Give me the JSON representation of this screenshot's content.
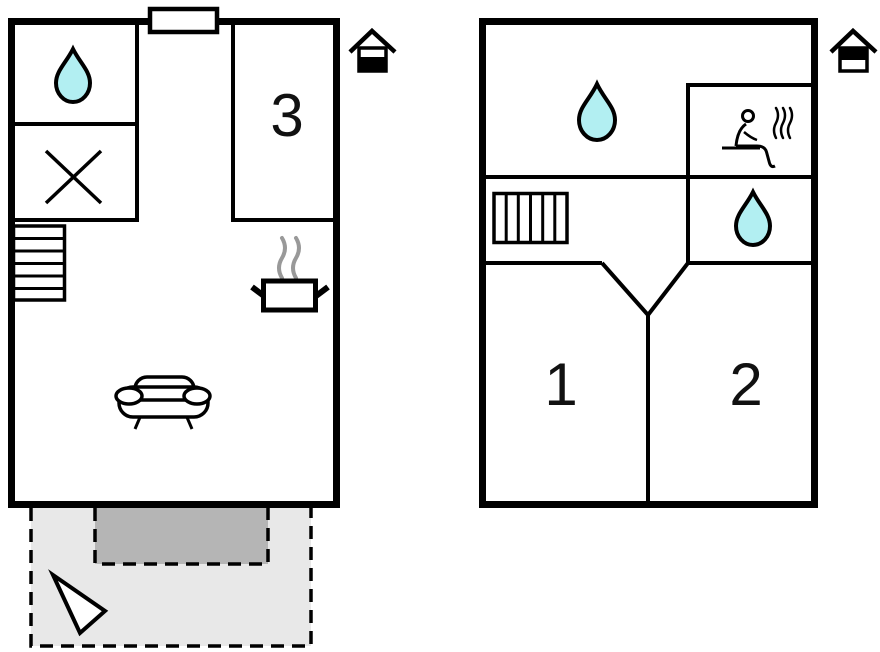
{
  "rooms": {
    "room1": "1",
    "room2": "2",
    "room3": "3"
  },
  "colors": {
    "wall": "#000000",
    "waterDrop": "#b2eff2",
    "terrace": "#e8e8e8",
    "patio": "#b5b5b5",
    "steam": "#999999",
    "background": "#ffffff"
  },
  "icons": {
    "water": "teardrop",
    "closet": "x-cross",
    "stairs": "tread-bars",
    "kitchen": "pot-with-steam",
    "sofa": "two-seat-sofa",
    "sauna": "person-with-steam",
    "groundLevel": "house-lower-half-filled",
    "upperLevel": "house-upper-half-filled",
    "north": "triangle-arrow",
    "entrance": "door-window-rect"
  }
}
